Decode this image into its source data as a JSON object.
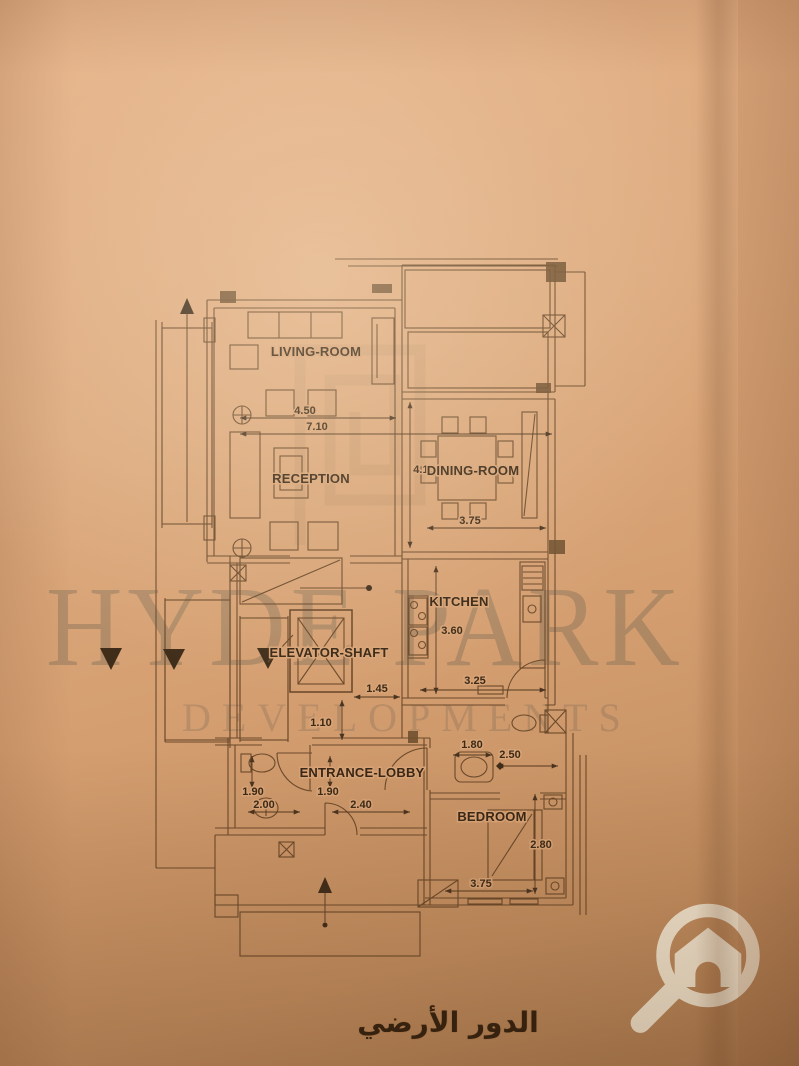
{
  "watermark": {
    "line1": "HYDE PARK",
    "line2": "DEVELOPMENTS"
  },
  "caption": {
    "arabic": "الدور الأرضي"
  },
  "rooms": {
    "living": "LIVING-ROOM",
    "reception": "RECEPTION",
    "dining": "DINING-ROOM",
    "kitchen": "KITCHEN",
    "elevator": "ELEVATOR-SHAFT",
    "lobby": "ENTRANCE-LOBBY",
    "bedroom": "BEDROOM"
  },
  "dims": {
    "living_w": "4.50",
    "overall_w": "7.10",
    "dining_h": "4.15",
    "dining_w": "3.75",
    "kitchen_h": "3.60",
    "kitchen_w": "3.25",
    "hall_w": "1.45",
    "hall_d": "1.10",
    "bath_w": "1.80",
    "bath_d": "2.50",
    "wc_h": "1.90",
    "wc_w": "2.00",
    "lobby_h": "1.90",
    "lobby_w": "2.40",
    "bedroom_h": "2.80",
    "bedroom_w": "3.75"
  },
  "icons": {
    "logo": "magnifier-house-logo",
    "stairs_up": "stairs-up-arrow",
    "stairs_down": "stairs-down-arrow"
  },
  "colors": {
    "paper": "#d9a477",
    "ink": "#6b4a2b",
    "label_ink": "#392715",
    "watermark": "#5c584c",
    "logo_cream": "#f2e7d2"
  }
}
